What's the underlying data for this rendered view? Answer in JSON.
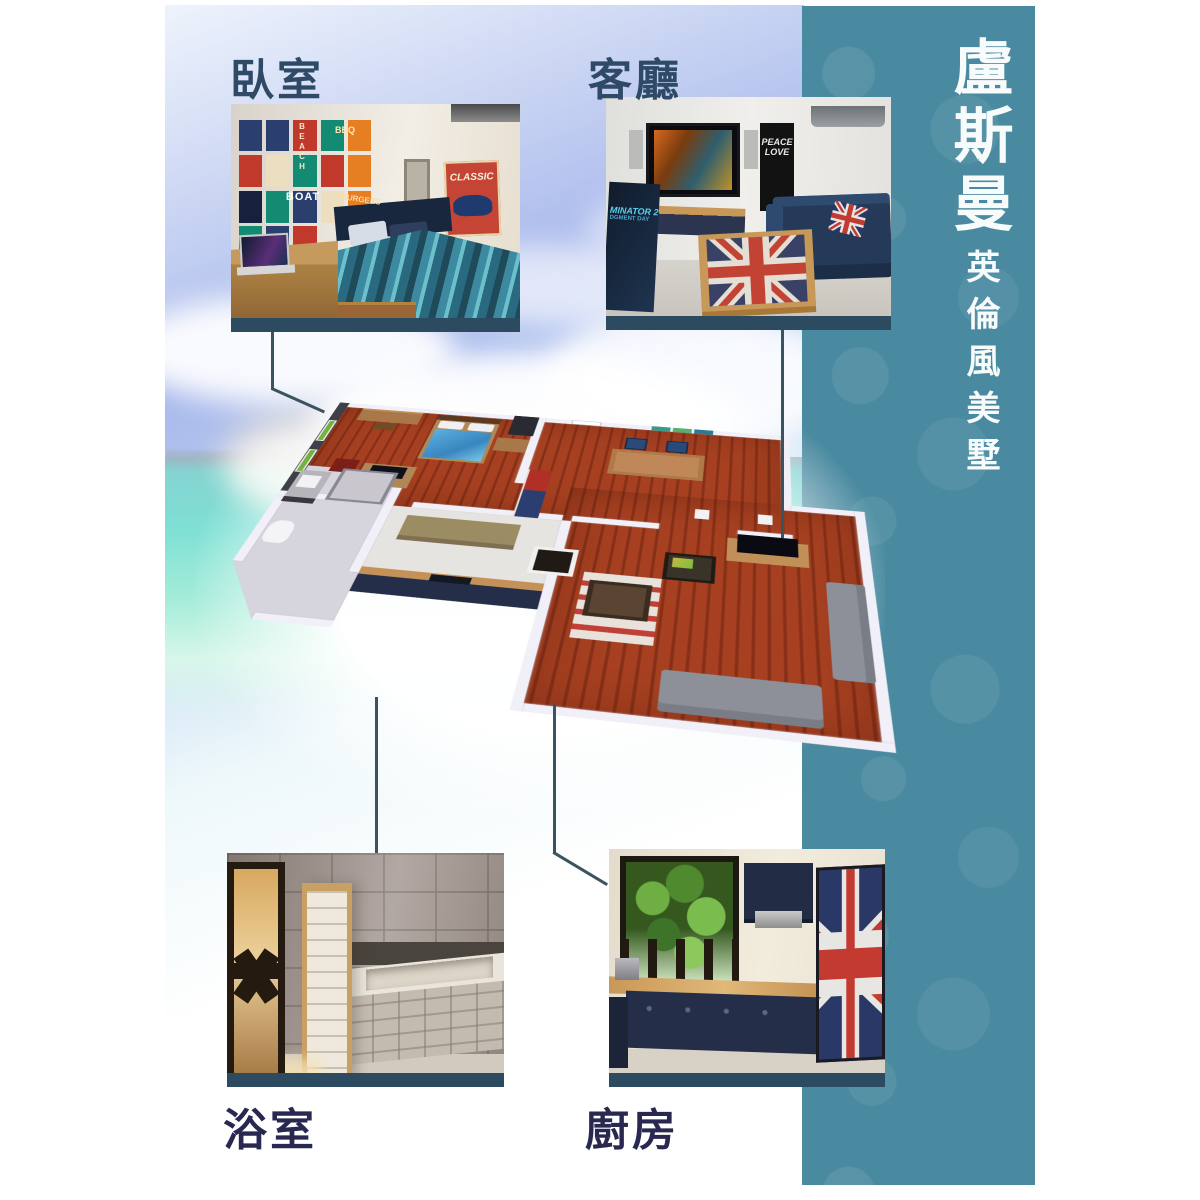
{
  "banner": {
    "title": "盧斯曼",
    "subtitle": "英倫風美墅",
    "bg_color": "#4a8aa0",
    "text_color": "#f8fbfc"
  },
  "labels": {
    "bedroom": "臥室",
    "living": "客廳",
    "bathroom": "浴室",
    "kitchen": "廚房"
  },
  "bedroom_photo": {
    "poster_beach": "BEACH",
    "poster_bbq": "BBQ",
    "poster_boat": "BOAT",
    "poster_burgers": "BURGERS",
    "poster_classic": "CLASSIC"
  },
  "living_photo": {
    "wall_poster_line1": "PEACE",
    "wall_poster_line2": "LOVE",
    "pinball_line1": "MINATOR 2",
    "pinball_line2": "DGMENT DAY"
  },
  "colors": {
    "label_top": "#2e4a66",
    "label_bottom": "#282850",
    "photo_bar": "#2c4a60",
    "connector_line": "#3a535f",
    "floor_wood": "#9c3a1e",
    "ocean": "#7fe0d4"
  }
}
